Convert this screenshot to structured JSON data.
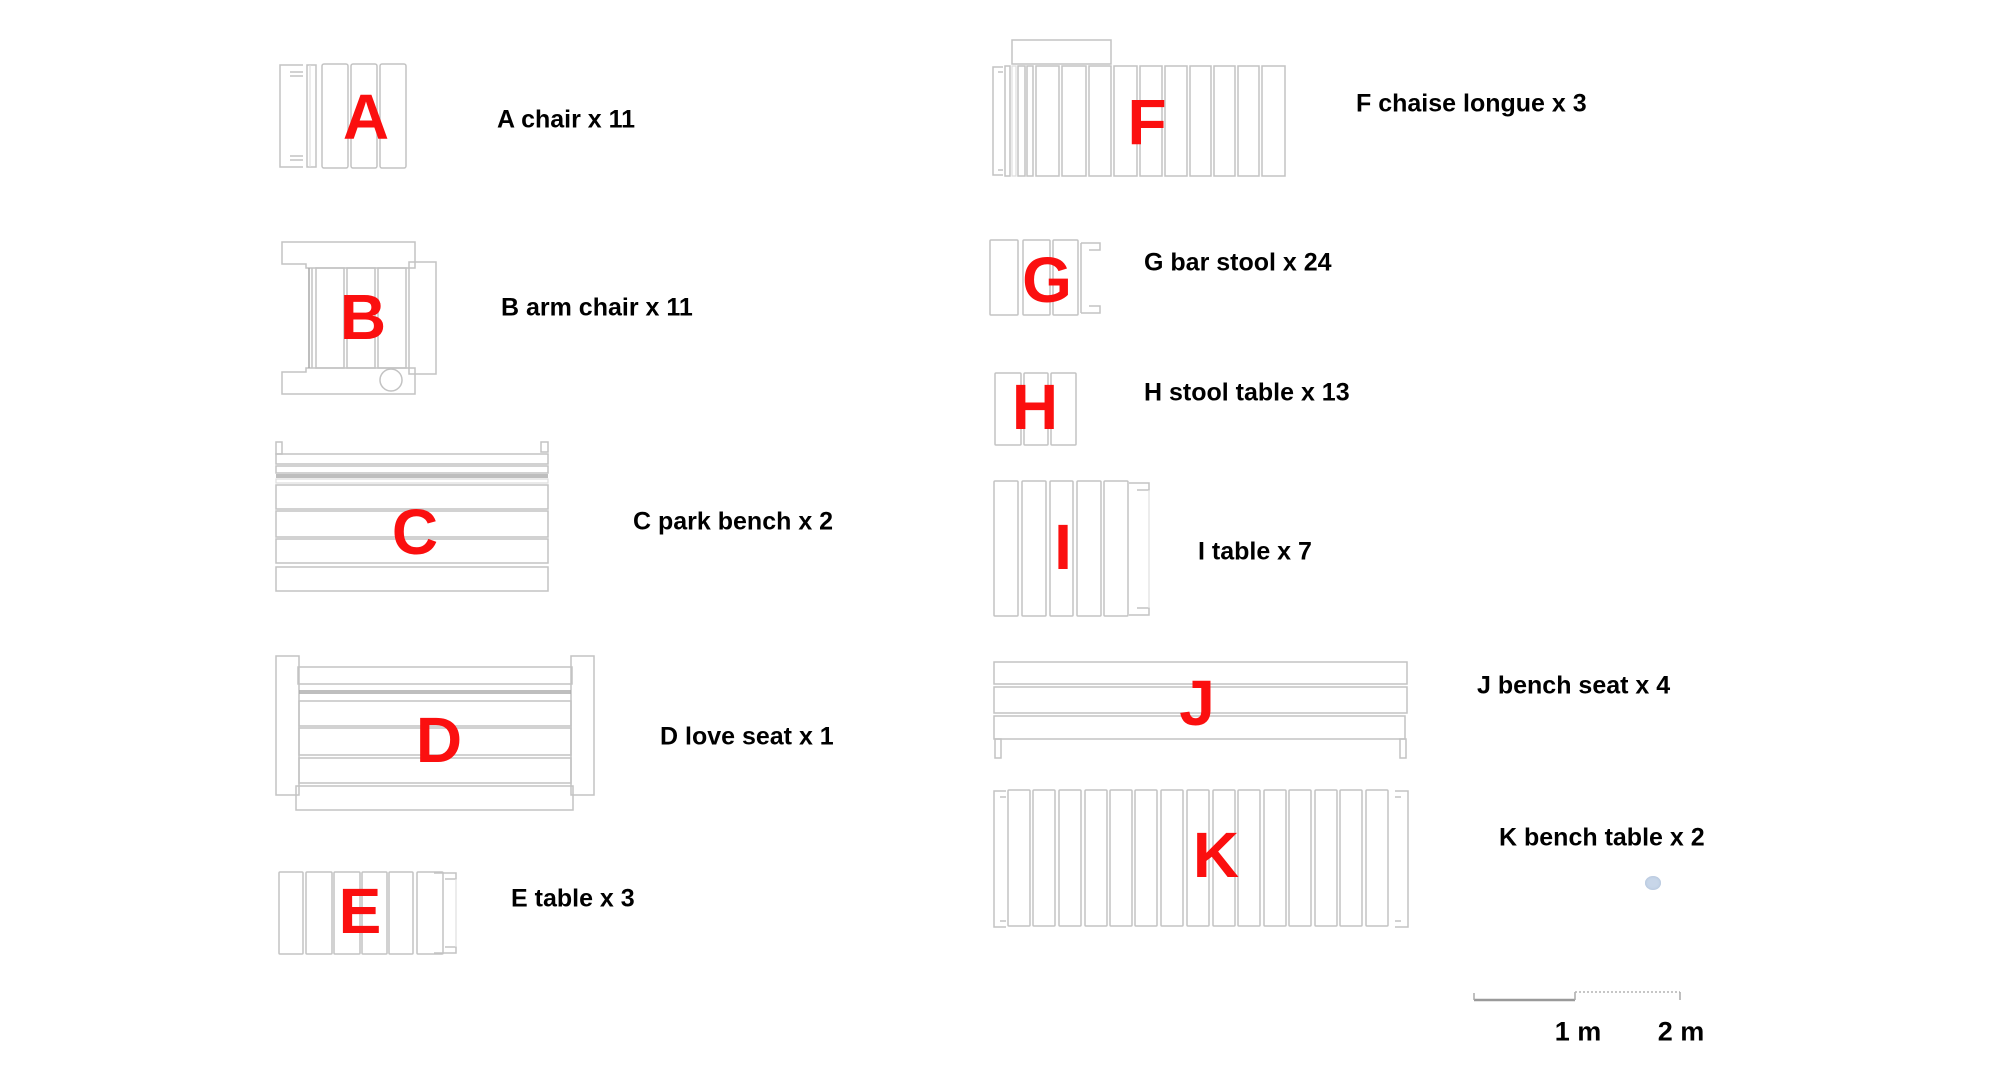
{
  "legend": {
    "items": [
      {
        "letter": "A",
        "label": "A chair x 11"
      },
      {
        "letter": "B",
        "label": "B arm chair x 11"
      },
      {
        "letter": "C",
        "label": "C park bench x 2"
      },
      {
        "letter": "D",
        "label": "D love seat x 1"
      },
      {
        "letter": "E",
        "label": "E table x 3"
      },
      {
        "letter": "F",
        "label": "F chaise longue x 3"
      },
      {
        "letter": "G",
        "label": "G bar stool x 24"
      },
      {
        "letter": "H",
        "label": "H stool table x 13"
      },
      {
        "letter": "I",
        "label": "I table x 7"
      },
      {
        "letter": "J",
        "label": "J bench seat x 4"
      },
      {
        "letter": "K",
        "label": "K bench table x 2"
      }
    ],
    "scale_bar": {
      "label_1m": "1 m",
      "label_2m": "2 m"
    },
    "colors": {
      "letter-red": "#fb0f0f",
      "drawing-outline": "#c3c3c3",
      "drawing-outline-dark": "#a8a8a8",
      "label-text": "#000000",
      "background": "#ffffff",
      "smudge-blue": "#bfd0e6"
    }
  }
}
